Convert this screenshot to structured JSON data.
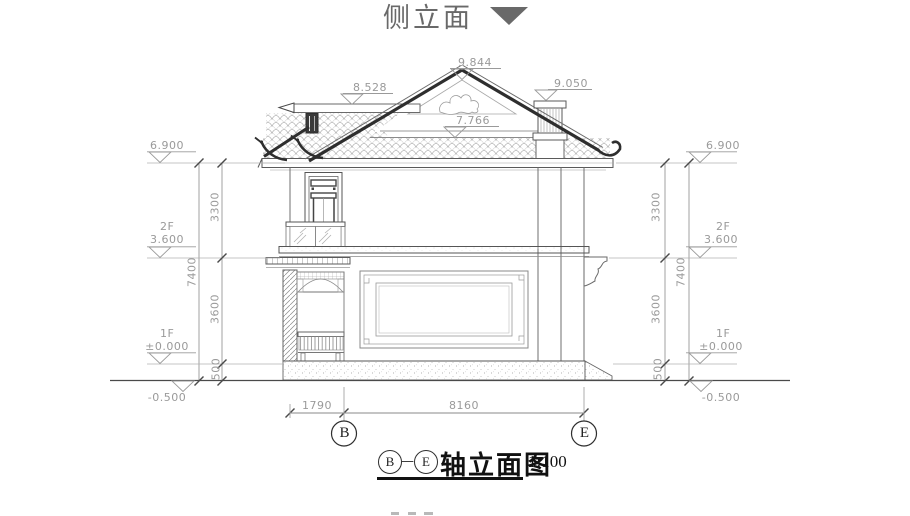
{
  "title": {
    "text": "侧立面"
  },
  "roof_marks": {
    "peak": "9.844",
    "left_ridge": "8.528",
    "chimney": "9.050",
    "pediment": "7.766"
  },
  "left": {
    "top_level": "6.900",
    "floor2_label": "2F",
    "floor2_level": "3.600",
    "floor1_label": "1F",
    "floor1_level": "±0.000",
    "ground_level": "-0.500",
    "dim_upper": "3300",
    "dim_lower": "3600",
    "dim_base": "500",
    "dim_total": "7400"
  },
  "right": {
    "top_level": "6.900",
    "floor2_label": "2F",
    "floor2_level": "3.600",
    "floor1_label": "1F",
    "floor1_level": "±0.000",
    "ground_level": "-0.500",
    "dim_upper": "3300",
    "dim_lower": "3600",
    "dim_base": "500",
    "dim_total": "7400"
  },
  "bottom": {
    "dim_left": "1790",
    "dim_main": "8160",
    "axis_start": "B",
    "axis_end": "E"
  },
  "caption": {
    "axis_start": "B",
    "dash": "—",
    "axis_end": "E",
    "text": "轴立面图",
    "scale": "1:100"
  },
  "colors": {
    "dim_text": "#9a9a9a",
    "line": "#8a8a8a",
    "dark": "#2e2e2e",
    "ink": "#1c1c1c",
    "title": "#696969"
  }
}
